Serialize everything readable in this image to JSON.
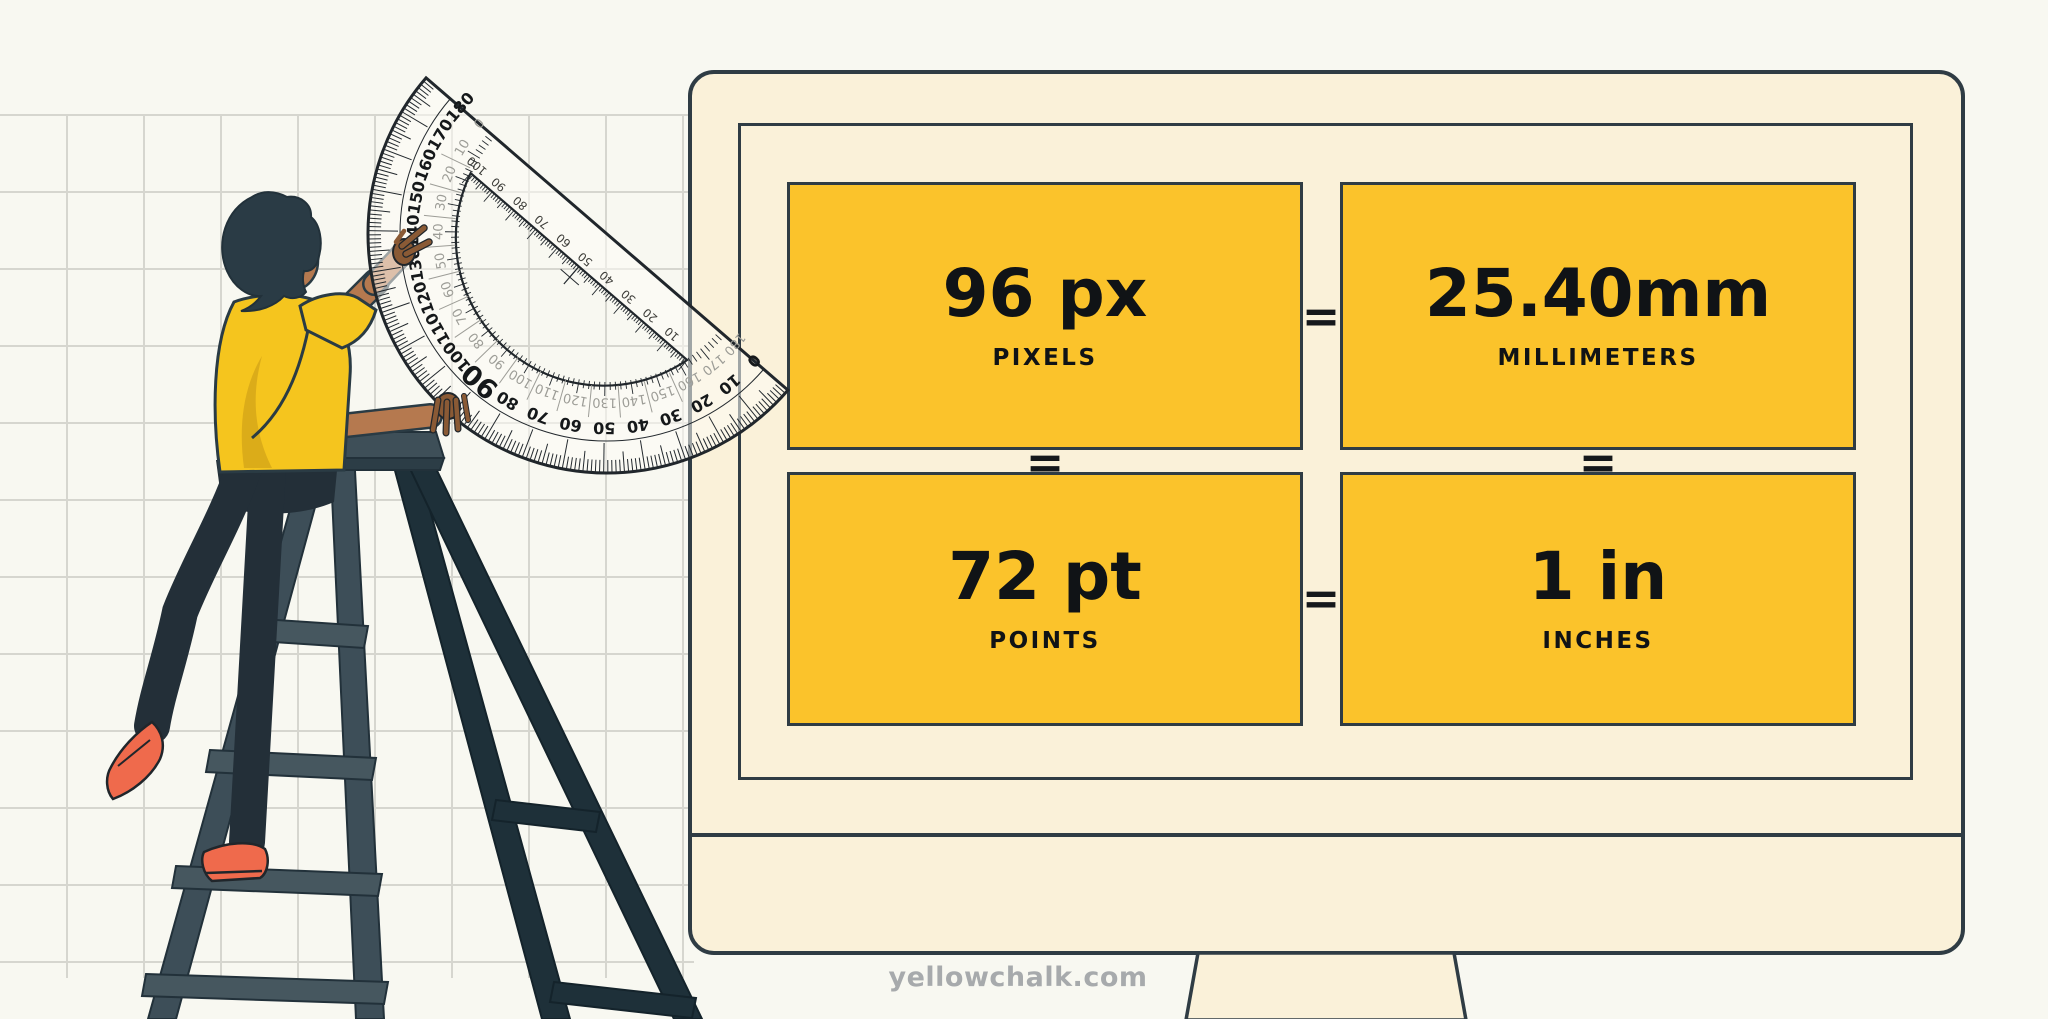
{
  "page": {
    "background_color": "#F8F8F1",
    "site_credit": "yellowchalk.com"
  },
  "conversion": {
    "equals_symbol": "=",
    "cards": [
      {
        "value": "96 px",
        "label": "PIXELS"
      },
      {
        "value": "25.40mm",
        "label": "MILLIMETERS"
      },
      {
        "value": "72 pt",
        "label": "POINTS"
      },
      {
        "value": "1 in",
        "label": "INCHES"
      }
    ]
  },
  "colors": {
    "card_yellow": "#FBC32B",
    "monitor_cream": "#FAF1D9",
    "outline_dark": "#2F3C44",
    "shirt_yellow": "#F5C51E",
    "skin": "#B5794F",
    "shoe_coral": "#EF6A4C",
    "grid_line": "#D6D6CF",
    "credit_gray": "#A7AAAC"
  },
  "illustration": {
    "protractor": {
      "degree_labels": [
        0,
        10,
        20,
        30,
        40,
        50,
        60,
        70,
        80,
        90,
        100,
        110,
        120,
        130,
        140,
        150,
        160,
        170,
        180
      ],
      "ruler_labels": [
        10,
        20,
        30,
        40,
        50,
        60,
        70,
        80,
        90,
        100
      ]
    }
  }
}
